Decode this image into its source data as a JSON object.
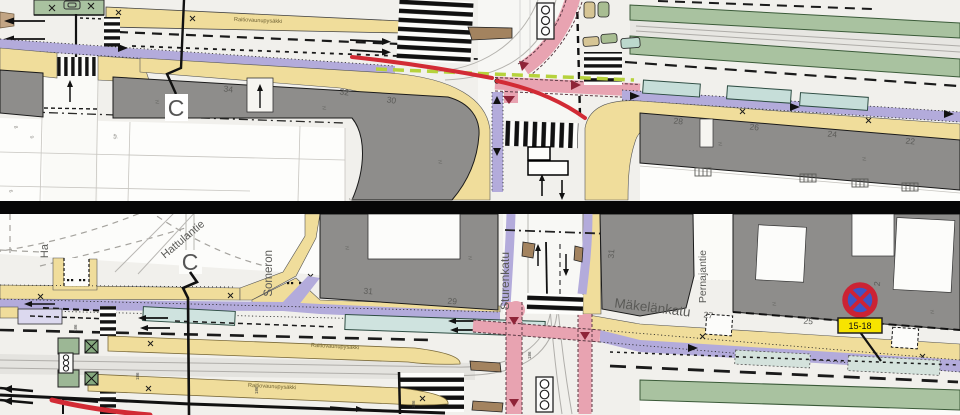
{
  "app": {
    "type": "street-traffic-plan-drawing",
    "panels": 2
  },
  "colors": {
    "sidewalk_yellow": "#f0dd9b",
    "building_gray": "#8e8d8b",
    "bike_lane_purple": "#b3abdb",
    "parking_lavender": "#dcd9ef",
    "tram_grass_green": "#a9c2a0",
    "parking_bay_teal": "#c6ded9",
    "crossing_pink": "#e8a3b1",
    "route_red": "#d22b35",
    "guide_lime": "#b6d23c",
    "platform_brown": "#a3835f",
    "sign_blue": "#3d55c5",
    "sign_red": "#cb2334",
    "plate_yellow": "#f7e400"
  },
  "annotations": {
    "floor_mark": "IV",
    "chainage": "186"
  },
  "top_panel": {
    "tram_stop_label": "Raitiovaunupysäkki",
    "section_marker": "C",
    "building_numbers": [
      "34",
      "32",
      "30",
      "28",
      "26",
      "24",
      "22"
    ],
    "lot_numbers": [
      "8",
      "9",
      "45",
      "6",
      "3"
    ]
  },
  "bottom_panel": {
    "section_marker": "C",
    "streets": {
      "partial_left": "Ha",
      "hattulantie": "Hattulantie",
      "somerontie": "Someron",
      "sturenkatu": "Sturenkatu",
      "makelankatu": "Mäkelänkatu",
      "pernajantie": "Pernajantie"
    },
    "tram_stop_label_upper": "Raitiovaunupysäkki",
    "tram_stop_label_lower": "Raitiovaunupysäkki",
    "building_numbers": [
      "31",
      "29",
      "31",
      "27",
      "25",
      "2"
    ],
    "no_stopping_sign": {
      "icon": "no-stopping-sign",
      "time_plate": "15-18"
    }
  }
}
